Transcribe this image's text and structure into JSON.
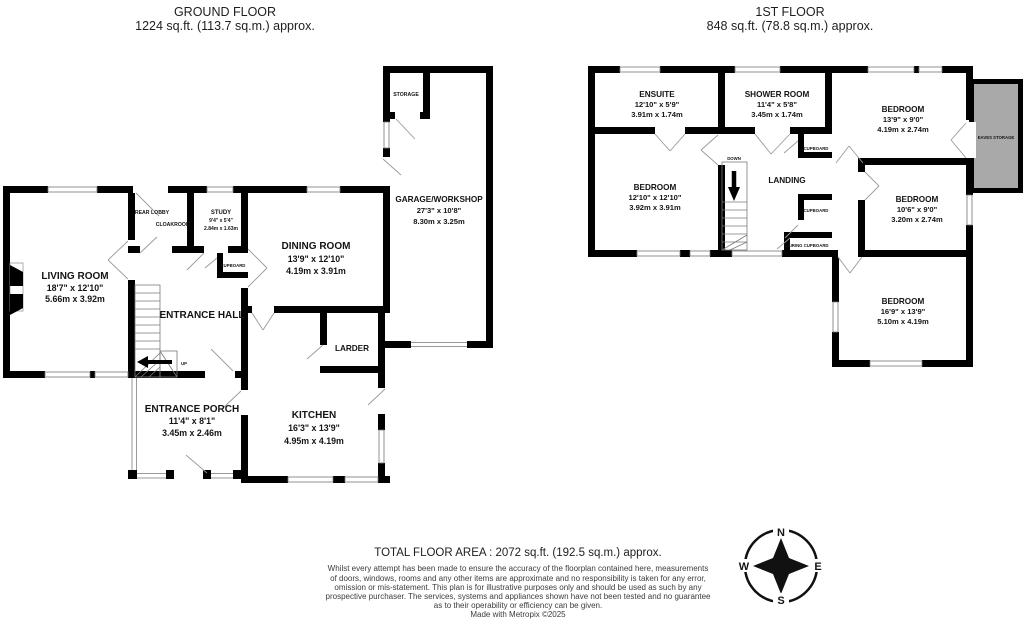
{
  "ground_floor": {
    "title": "GROUND FLOOR",
    "subtitle": "1224 sq.ft. (113.7 sq.m.) approx.",
    "rooms": {
      "living_room": {
        "name": "LIVING ROOM",
        "dims_ft": "18'7\" x 12'10\"",
        "dims_m": "5.66m x 3.92m"
      },
      "rear_lobby": {
        "name": "REAR LOBBY"
      },
      "cloakroom": {
        "name": "CLOAKROOM"
      },
      "study": {
        "name": "STUDY",
        "dims_ft": "9'4\" x 5'4\"",
        "dims_m": "2.84m x 1.63m"
      },
      "cupboard": {
        "name": "CUPBOARD"
      },
      "dining_room": {
        "name": "DINING ROOM",
        "dims_ft": "13'9\" x 12'10\"",
        "dims_m": "4.19m x 3.91m"
      },
      "entrance_hall": {
        "name": "ENTRANCE HALL"
      },
      "larder": {
        "name": "LARDER"
      },
      "kitchen": {
        "name": "KITCHEN",
        "dims_ft": "16'3\" x 13'9\"",
        "dims_m": "4.95m x 4.19m"
      },
      "entrance_porch": {
        "name": "ENTRANCE PORCH",
        "dims_ft": "11'4\" x 8'1\"",
        "dims_m": "3.45m x 2.46m"
      },
      "garage": {
        "name": "GARAGE/WORKSHOP",
        "dims_ft": "27'3\" x 10'8\"",
        "dims_m": "8.30m x 3.25m"
      },
      "storage": {
        "name": "STORAGE"
      },
      "stairs_label": "UP"
    }
  },
  "first_floor": {
    "title": "1ST FLOOR",
    "subtitle": "848 sq.ft. (78.8 sq.m.) approx.",
    "rooms": {
      "ensuite": {
        "name": "ENSUITE",
        "dims_ft": "12'10\" x 5'9\"",
        "dims_m": "3.91m x 1.74m"
      },
      "shower_room": {
        "name": "SHOWER ROOM",
        "dims_ft": "11'4\" x 5'8\"",
        "dims_m": "3.45m x 1.74m"
      },
      "bedroom_1": {
        "name": "BEDROOM",
        "dims_ft": "13'9\" x 9'0\"",
        "dims_m": "4.19m x 2.74m"
      },
      "bedroom_2": {
        "name": "BEDROOM",
        "dims_ft": "12'10\" x 12'10\"",
        "dims_m": "3.92m x 3.91m"
      },
      "bedroom_3": {
        "name": "BEDROOM",
        "dims_ft": "10'6\" x 9'0\"",
        "dims_m": "3.20m x 2.74m"
      },
      "bedroom_4": {
        "name": "BEDROOM",
        "dims_ft": "16'9\" x 13'9\"",
        "dims_m": "5.10m x 4.19m"
      },
      "landing": {
        "name": "LANDING"
      },
      "eaves_storage": {
        "name": "EAVES STORAGE"
      },
      "cupboard_1": {
        "name": "CUPBOARD"
      },
      "cupboard_2": {
        "name": "CUPBOARD"
      },
      "airing_cupboard": {
        "name": "AIRING CUPBOARD"
      },
      "stairs_label": "DOWN"
    }
  },
  "footer": {
    "total_area": "TOTAL FLOOR AREA : 2072 sq.ft. (192.5 sq.m.) approx.",
    "disclaimer_lines": [
      "Whilst every attempt has been made to ensure the accuracy of the floorplan contained here, measurements",
      "of doors, windows, rooms and any other items are approximate and no responsibility is taken for any error,",
      "omission or mis-statement. This plan is for illustrative purposes only and should be used as such by any",
      "prospective purchaser. The services, systems and appliances shown have not been tested and no guarantee",
      "as to their operability or efficiency can be given."
    ],
    "credit": "Made with Metropix ©2025"
  },
  "compass": {
    "north": "N",
    "east": "E",
    "south": "S",
    "west": "W"
  },
  "colors": {
    "wall": "#000000",
    "eaves_fill": "#a9a9a9",
    "thin_line": "#888888"
  }
}
